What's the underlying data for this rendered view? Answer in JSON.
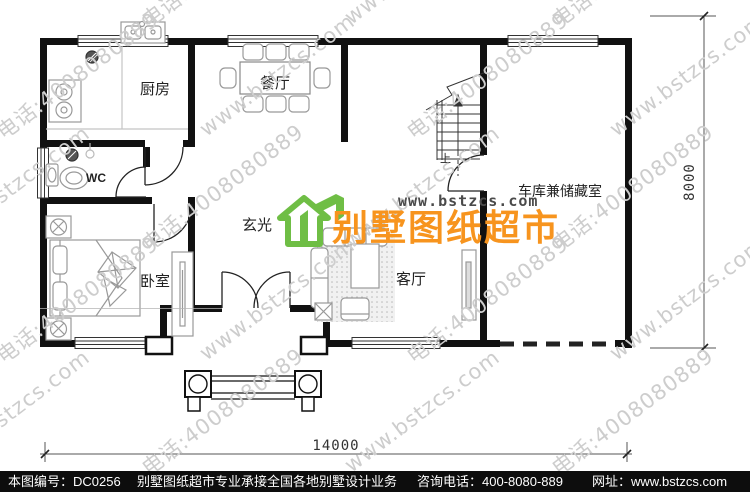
{
  "rooms": {
    "kitchen": "厨房",
    "dining": "餐厅",
    "wc": "WC",
    "bedroom": "卧室",
    "foyer": "玄光",
    "living": "客厅",
    "garage": "车库兼储藏室",
    "stair_up": "上"
  },
  "dimensions": {
    "width": "14000",
    "height": "8000"
  },
  "logo": {
    "site": "www.bstzcs.com",
    "name": "别墅图纸超市",
    "green": "#6FBE45",
    "orange": "#F7941E"
  },
  "watermark": {
    "site_text": "www.bstzcs.com",
    "phone_text": "电话:4008080889",
    "color": "#cdcdcd"
  },
  "footer": {
    "drawing_no": "本图编号：DC0256",
    "slogan": "别墅图纸超市专业承接全国各地别墅设计业务",
    "phone": "咨询电话：400-8080-889",
    "website": "网址：www.bstzcs.com"
  }
}
